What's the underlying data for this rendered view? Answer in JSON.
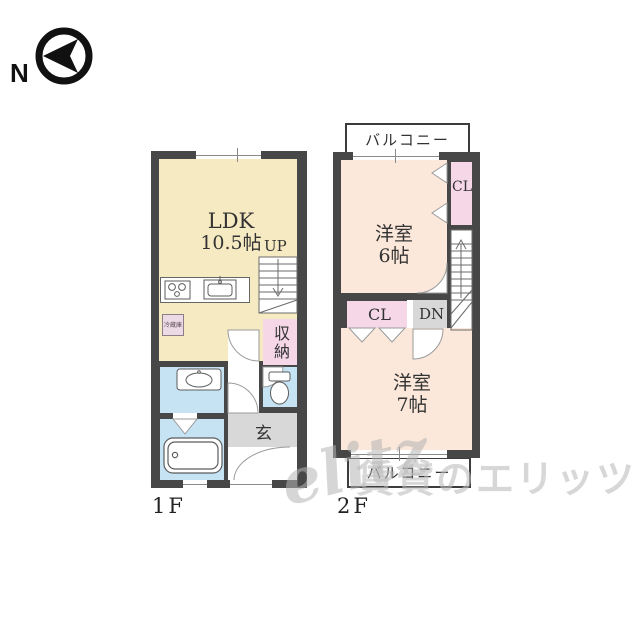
{
  "compass": {
    "label": "N"
  },
  "watermark": {
    "logo": "elitz",
    "text": "賃貸のエリッツ"
  },
  "colors": {
    "wall": "#474747",
    "ldk_yellow": "#f6eac2",
    "western_room_peach": "#fbe8da",
    "closet_pink": "#f5d7e8",
    "wet_area_blue": "#c5e3f3",
    "hall_gray": "#d8d8d8"
  },
  "floor1": {
    "label": "1F",
    "ldk_name": "LDK",
    "ldk_size": "10.5帖",
    "up": "UP",
    "storage": "収納",
    "genkan": "玄",
    "fridge": "冷蔵庫"
  },
  "floor2": {
    "label": "2F",
    "balcony_top": "バルコニー",
    "balcony_bottom": "バルコニー",
    "room6_name": "洋室",
    "room6_size": "6帖",
    "cl_upper": "CL",
    "cl_mid": "CL",
    "dn": "DN",
    "room7_name": "洋室",
    "room7_size": "7帖"
  }
}
